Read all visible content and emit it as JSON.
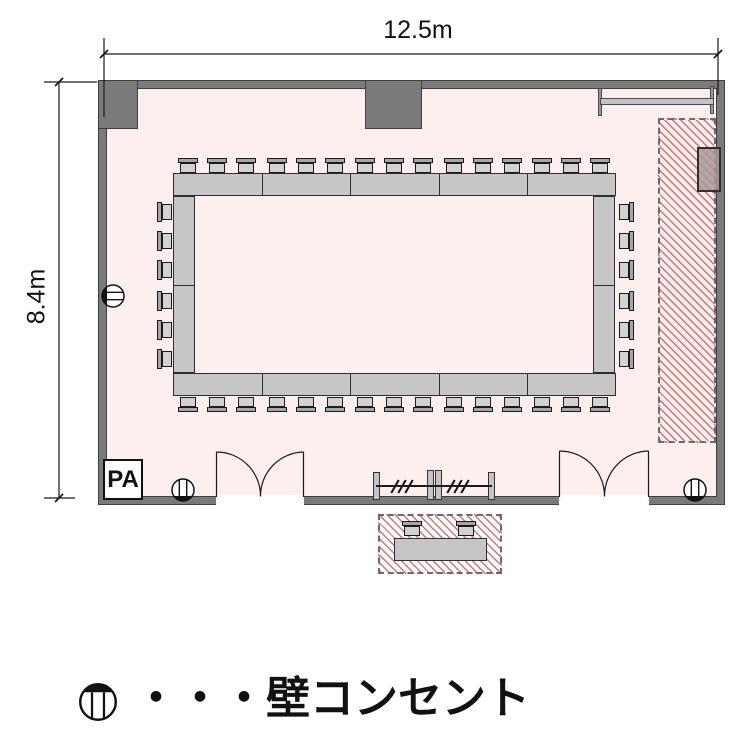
{
  "dimension_labels": {
    "width": "12.5m",
    "height": "8.4m"
  },
  "pa_box": {
    "label": "PA"
  },
  "legend": {
    "symbol": "wall-outlet-icon",
    "item_label": "・・・壁コンセント"
  },
  "colors": {
    "floor": "#fdefed",
    "wall": "#7a7a7a",
    "wall_edge": "#3f3f3f",
    "table_fill": "#c6c6c6",
    "table_edge": "#2e2e2e",
    "chair_fill": "#d2d2d2",
    "chair_back": "#a6a6a6",
    "hatch_red": "#c34646",
    "line": "#1a1a1a"
  },
  "furniture": {
    "top_row": {
      "table_segments": 5,
      "chairs_per_segment": 3
    },
    "bottom_row": {
      "table_segments": 5,
      "chairs_per_segment": 3
    },
    "left_column": {
      "table_segments": 2,
      "chairs_per_segment": 3
    },
    "right_column": {
      "table_segments": 2,
      "chairs_per_segment": 3
    },
    "outside_reception": {
      "table_segments": 1,
      "chairs": 2
    }
  },
  "outlets": [
    {
      "id": "left-wall",
      "facing": "left"
    },
    {
      "id": "bottom-left",
      "facing": "down"
    },
    {
      "id": "bottom-right",
      "facing": "down"
    }
  ]
}
